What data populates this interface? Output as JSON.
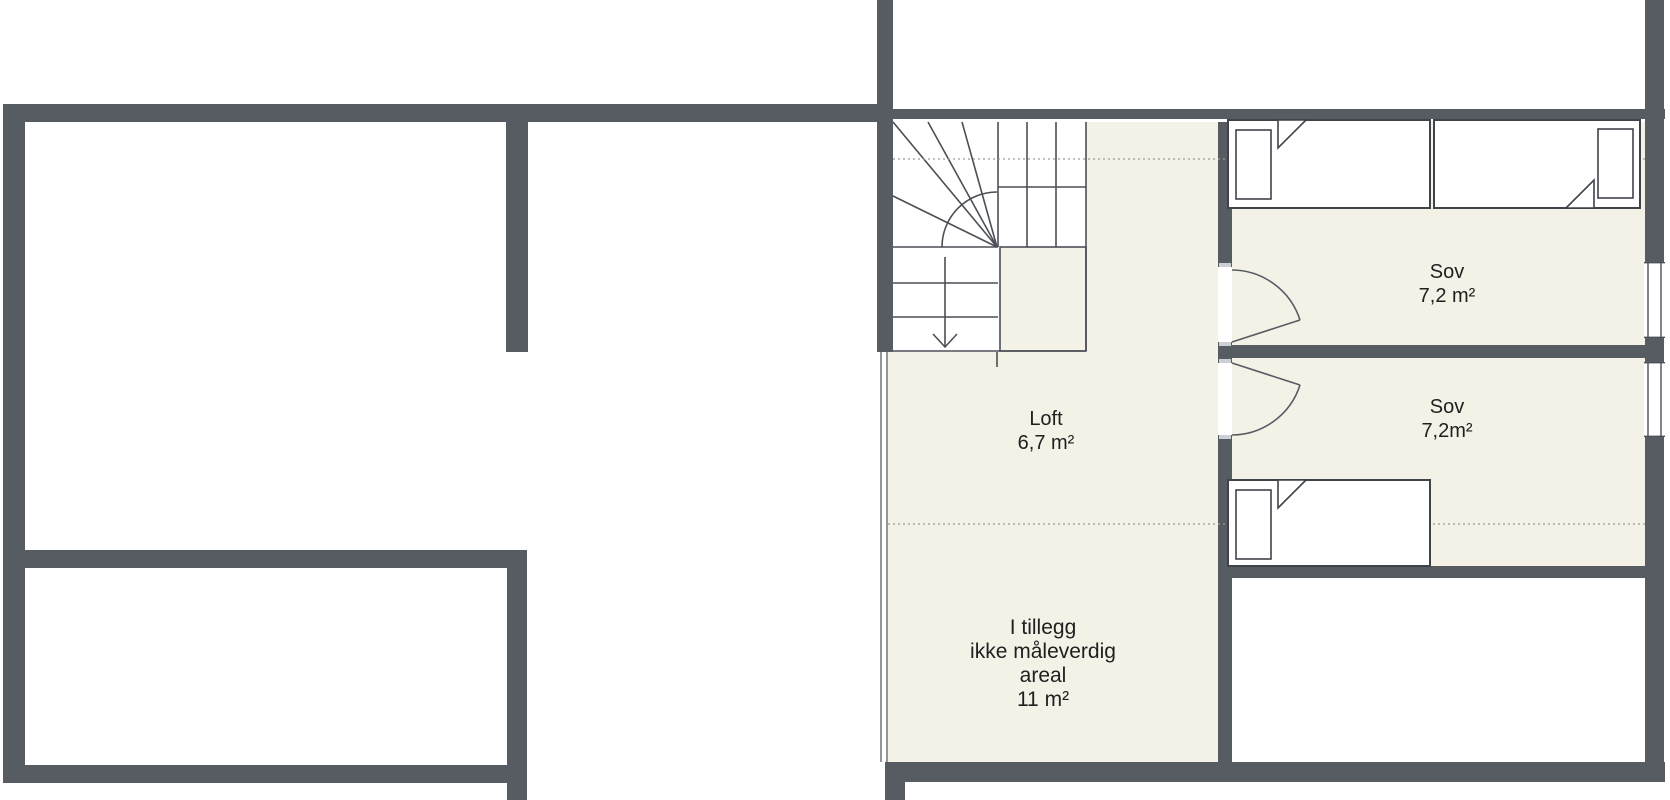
{
  "plan": {
    "title": "Loftsplan / floor plan",
    "rooms": {
      "loft": {
        "name": "Loft",
        "area": "6,7 m²"
      },
      "bedroom1": {
        "name": "Sov",
        "area": "7,2 m²"
      },
      "bedroom2": {
        "name": "Sov",
        "area": "7,2m²"
      },
      "extra": {
        "lines": [
          "I tillegg",
          "ikke måleverdig",
          "areal",
          "11 m²"
        ]
      }
    },
    "stairs": {
      "direction_icon": "stairs-down-arrow-icon"
    },
    "colors": {
      "wall": "#575b62",
      "floor": "#f4f1e7",
      "line": "#4b4f56",
      "dotted": "#9b9b96",
      "text": "#1f1f1f",
      "bg": "#ffffff"
    }
  }
}
